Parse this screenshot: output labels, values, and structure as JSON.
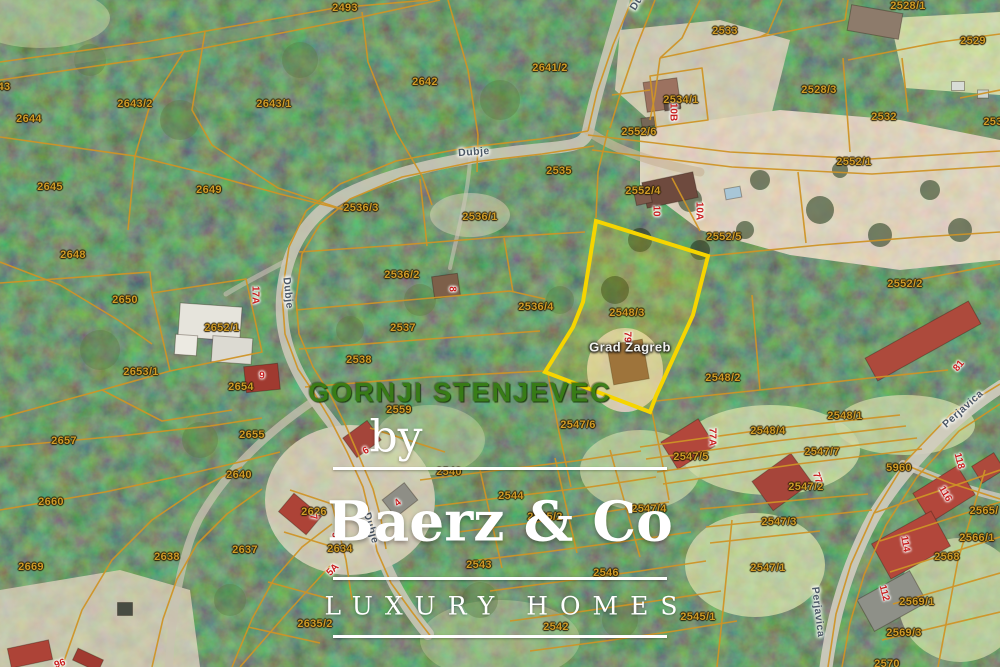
{
  "map": {
    "area_label": "GORNJI STENJEVEC",
    "highlighted_parcel": {
      "number": "2548/3",
      "owner": "Grad Zagreb",
      "house_number": "79",
      "border_color": "#f6d500"
    },
    "parcel_labels": [
      {
        "t": "2493",
        "x": 345,
        "y": 8
      },
      {
        "t": "43",
        "x": 4,
        "y": 87
      },
      {
        "t": "2643/2",
        "x": 135,
        "y": 104
      },
      {
        "t": "2643/1",
        "x": 274,
        "y": 104
      },
      {
        "t": "2644",
        "x": 29,
        "y": 119
      },
      {
        "t": "2642",
        "x": 425,
        "y": 82
      },
      {
        "t": "2641/2",
        "x": 550,
        "y": 68
      },
      {
        "t": "2533",
        "x": 725,
        "y": 31
      },
      {
        "t": "2528/1",
        "x": 908,
        "y": 6
      },
      {
        "t": "2529",
        "x": 973,
        "y": 41
      },
      {
        "t": "2528/3",
        "x": 819,
        "y": 90
      },
      {
        "t": "2532",
        "x": 884,
        "y": 117
      },
      {
        "t": "253",
        "x": 993,
        "y": 122
      },
      {
        "t": "2534/1",
        "x": 681,
        "y": 100
      },
      {
        "t": "2552/6",
        "x": 639,
        "y": 132
      },
      {
        "t": "2535",
        "x": 559,
        "y": 171
      },
      {
        "t": "2552/1",
        "x": 854,
        "y": 162
      },
      {
        "t": "2552/4",
        "x": 643,
        "y": 191
      },
      {
        "t": "2645",
        "x": 50,
        "y": 187
      },
      {
        "t": "2649",
        "x": 209,
        "y": 190
      },
      {
        "t": "2536/3",
        "x": 361,
        "y": 208
      },
      {
        "t": "2536/1",
        "x": 480,
        "y": 217
      },
      {
        "t": "2552/5",
        "x": 724,
        "y": 237
      },
      {
        "t": "2648",
        "x": 73,
        "y": 255
      },
      {
        "t": "2536/2",
        "x": 402,
        "y": 275
      },
      {
        "t": "2552/2",
        "x": 905,
        "y": 284
      },
      {
        "t": "2650",
        "x": 125,
        "y": 300
      },
      {
        "t": "2536/4",
        "x": 536,
        "y": 307
      },
      {
        "t": "2548/3",
        "x": 627,
        "y": 313
      },
      {
        "t": "2537",
        "x": 403,
        "y": 328
      },
      {
        "t": "2652/1",
        "x": 222,
        "y": 328
      },
      {
        "t": "2538",
        "x": 359,
        "y": 360
      },
      {
        "t": "2653/1",
        "x": 141,
        "y": 372
      },
      {
        "t": "2548/2",
        "x": 723,
        "y": 378
      },
      {
        "t": "2654",
        "x": 241,
        "y": 387
      },
      {
        "t": "2559",
        "x": 399,
        "y": 410
      },
      {
        "t": "2548/1",
        "x": 845,
        "y": 416
      },
      {
        "t": "2547/6",
        "x": 578,
        "y": 425
      },
      {
        "t": "2655",
        "x": 252,
        "y": 435
      },
      {
        "t": "2548/4",
        "x": 768,
        "y": 431
      },
      {
        "t": "2657",
        "x": 64,
        "y": 441
      },
      {
        "t": "2547/7",
        "x": 822,
        "y": 452
      },
      {
        "t": "2547/5",
        "x": 691,
        "y": 457
      },
      {
        "t": "5960",
        "x": 899,
        "y": 468
      },
      {
        "t": "2540",
        "x": 449,
        "y": 472
      },
      {
        "t": "2640",
        "x": 239,
        "y": 475
      },
      {
        "t": "2547/2",
        "x": 806,
        "y": 487
      },
      {
        "t": "2544",
        "x": 511,
        "y": 496
      },
      {
        "t": "2660",
        "x": 51,
        "y": 502
      },
      {
        "t": "2626",
        "x": 314,
        "y": 512
      },
      {
        "t": "2565/",
        "x": 984,
        "y": 511
      },
      {
        "t": "2547/4",
        "x": 649,
        "y": 509
      },
      {
        "t": "2545/2",
        "x": 545,
        "y": 517
      },
      {
        "t": "2547/3",
        "x": 779,
        "y": 522
      },
      {
        "t": "2566/1",
        "x": 977,
        "y": 538
      },
      {
        "t": "2634",
        "x": 340,
        "y": 549
      },
      {
        "t": "2637",
        "x": 245,
        "y": 550
      },
      {
        "t": "2638",
        "x": 167,
        "y": 557
      },
      {
        "t": "2568",
        "x": 947,
        "y": 557
      },
      {
        "t": "2543",
        "x": 479,
        "y": 565
      },
      {
        "t": "2669",
        "x": 31,
        "y": 567
      },
      {
        "t": "2547/1",
        "x": 768,
        "y": 568
      },
      {
        "t": "2546",
        "x": 606,
        "y": 573
      },
      {
        "t": "2569/1",
        "x": 917,
        "y": 602
      },
      {
        "t": "2545/1",
        "x": 698,
        "y": 617
      },
      {
        "t": "2635/2",
        "x": 315,
        "y": 624
      },
      {
        "t": "2542",
        "x": 556,
        "y": 627
      },
      {
        "t": "2569/3",
        "x": 904,
        "y": 633
      },
      {
        "t": "2570",
        "x": 887,
        "y": 664
      }
    ],
    "house_numbers": [
      {
        "t": "10B",
        "x": 673,
        "y": 112,
        "r": 90
      },
      {
        "t": "10",
        "x": 656,
        "y": 211,
        "r": 90
      },
      {
        "t": "10A",
        "x": 699,
        "y": 211,
        "r": 90
      },
      {
        "t": "17A",
        "x": 255,
        "y": 295,
        "r": 90
      },
      {
        "t": "8",
        "x": 452,
        "y": 289,
        "r": 90
      },
      {
        "t": "9",
        "x": 262,
        "y": 376,
        "r": 0
      },
      {
        "t": "79",
        "x": 627,
        "y": 337,
        "r": 90
      },
      {
        "t": "81",
        "x": 959,
        "y": 366,
        "r": -50
      },
      {
        "t": "77A",
        "x": 712,
        "y": 437,
        "r": 90
      },
      {
        "t": "77",
        "x": 817,
        "y": 478,
        "r": 70
      },
      {
        "t": "118",
        "x": 959,
        "y": 461,
        "r": 75
      },
      {
        "t": "116",
        "x": 945,
        "y": 494,
        "r": 60
      },
      {
        "t": "114",
        "x": 905,
        "y": 544,
        "r": 80
      },
      {
        "t": "112",
        "x": 884,
        "y": 593,
        "r": 75
      },
      {
        "t": "6",
        "x": 366,
        "y": 451,
        "r": -30
      },
      {
        "t": "4",
        "x": 398,
        "y": 503,
        "r": -40
      },
      {
        "t": "7",
        "x": 313,
        "y": 517,
        "r": 80
      },
      {
        "t": "5",
        "x": 335,
        "y": 535,
        "r": 85
      },
      {
        "t": "5A",
        "x": 333,
        "y": 570,
        "r": -45
      },
      {
        "t": "96",
        "x": 60,
        "y": 664,
        "r": -20
      }
    ],
    "street_labels": [
      {
        "t": "Dubje",
        "x": 474,
        "y": 152,
        "r": -4
      },
      {
        "t": "Dubje",
        "x": 288,
        "y": 293,
        "r": 84
      },
      {
        "t": "Dubje",
        "x": 371,
        "y": 528,
        "r": 74
      },
      {
        "t": "Dubje",
        "x": 641,
        "y": -4,
        "r": -58
      },
      {
        "t": "Perjavica",
        "x": 963,
        "y": 409,
        "r": -42
      },
      {
        "t": "Perjavica",
        "x": 818,
        "y": 612,
        "r": 83
      }
    ],
    "place_labels": [
      {
        "t": "Grad Zagreb",
        "x": 630,
        "y": 347,
        "r": 0
      }
    ],
    "colors": {
      "boundary_line": "#cf9426",
      "parcel_text": "#d09c28",
      "house_number_text": "#c81e1e",
      "street_text": "#4c5866",
      "district_text": "#337a10",
      "highlight_border": "#f6d500"
    }
  },
  "watermark": {
    "by": "by",
    "brand": "Baerz & Co",
    "tagline": "LUXURY HOMES"
  }
}
